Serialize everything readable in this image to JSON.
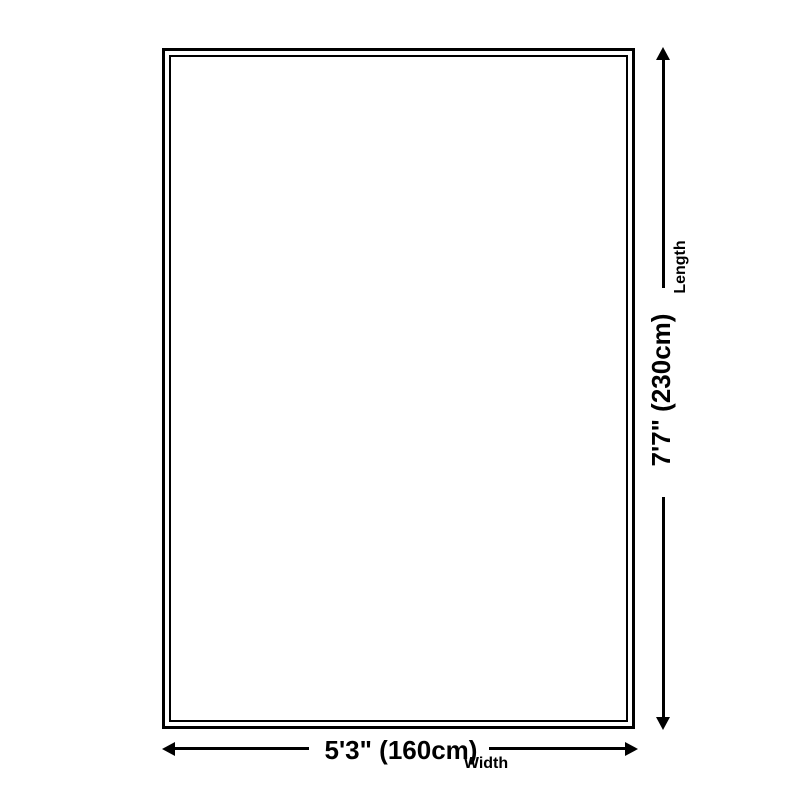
{
  "diagram": {
    "name": "rug-size-diagram",
    "background_color": "#ffffff",
    "line_color": "#000000",
    "text_color": "#000000",
    "length": {
      "value": "7'7\" (230cm)",
      "label": "Length",
      "orientation": "vertical"
    },
    "width": {
      "value": "5'3\" (160cm)",
      "label": "Width",
      "orientation": "horizontal"
    }
  }
}
